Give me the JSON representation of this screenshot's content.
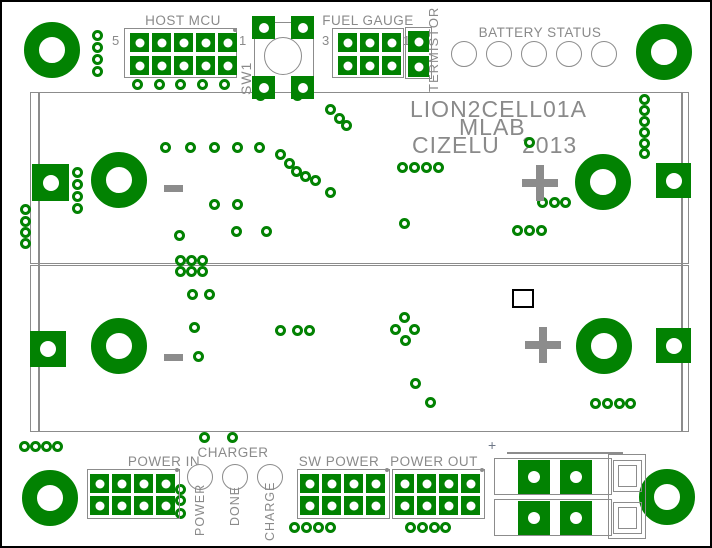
{
  "colors": {
    "pad_green": "#028202",
    "outline_gray": "#8c8c8c",
    "text_gray": "#8a8a8a",
    "frame_black": "#000000"
  },
  "title": {
    "line1": "LION2CELL01A",
    "line2": "MLAB",
    "line3_left": "CIZELU",
    "line3_right": "2013"
  },
  "pcb": {
    "mount_holes": [
      [
        50,
        48
      ],
      [
        662,
        50
      ],
      [
        48,
        496
      ],
      [
        665,
        495
      ]
    ],
    "battery_pads_round": [
      [
        117,
        178
      ],
      [
        601,
        180
      ],
      [
        117,
        344
      ],
      [
        602,
        344
      ]
    ],
    "battery_pads_square": [
      [
        30,
        162,
        37
      ],
      [
        654,
        161,
        35
      ],
      [
        28,
        329,
        36
      ],
      [
        654,
        326,
        35
      ]
    ],
    "holder": {
      "slot1": [
        28,
        90,
        659,
        172
      ],
      "slot2": [
        28,
        263,
        659,
        167
      ],
      "inner_lines_x": [
        36,
        679
      ],
      "inner_top": 90,
      "inner_height": 340
    },
    "headers": [
      {
        "id": "host-mcu",
        "label": "HOST MCU",
        "box": [
          122,
          26,
          113,
          50
        ],
        "cols": 5,
        "rows": 2,
        "x0": 128,
        "y0": 31,
        "pitch_x": 22,
        "pitch_y": 23,
        "pad": 19,
        "label_cx": 181,
        "label_y": 11,
        "pin_left": "5",
        "pl": [
          110,
          31
        ],
        "pin_right": "1",
        "pr": [
          237,
          31
        ],
        "dot": [
          231,
          26
        ]
      },
      {
        "id": "fuel-gauge",
        "label": "FUEL GAUGE",
        "box": [
          330,
          26,
          72,
          50
        ],
        "cols": 3,
        "rows": 2,
        "x0": 336,
        "y0": 31,
        "pitch_x": 22,
        "pitch_y": 23,
        "pad": 19,
        "label_cx": 366,
        "label_y": 11,
        "pin_left": "3",
        "pl": [
          320,
          31
        ],
        "pin_right": "1",
        "pr": [
          401,
          31
        ]
      },
      {
        "id": "termistor",
        "label": "",
        "box": [
          403,
          25,
          27,
          52
        ],
        "cols": 1,
        "rows": 2,
        "x0": 406,
        "y0": 29,
        "pitch_x": 22,
        "pitch_y": 25,
        "pad": 21
      },
      {
        "id": "power-in",
        "label": "POWER IN",
        "box": [
          85,
          467,
          93,
          50
        ],
        "cols": 4,
        "rows": 2,
        "x0": 88,
        "y0": 472,
        "pitch_x": 22,
        "pitch_y": 22,
        "pad": 19,
        "label_cx": 162,
        "label_y": 452,
        "dot": [
          173,
          466
        ]
      },
      {
        "id": "sw-power",
        "label": "SW POWER",
        "box": [
          295,
          467,
          93,
          50
        ],
        "cols": 4,
        "rows": 2,
        "x0": 298,
        "y0": 472,
        "pitch_x": 22,
        "pitch_y": 22,
        "pad": 19,
        "label_cx": 337,
        "label_y": 452,
        "dot": [
          383,
          466
        ]
      },
      {
        "id": "power-out",
        "label": "POWER OUT",
        "box": [
          390,
          467,
          93,
          50
        ],
        "cols": 4,
        "rows": 2,
        "x0": 393,
        "y0": 472,
        "pitch_x": 22,
        "pitch_y": 22,
        "pad": 19,
        "label_cx": 432,
        "label_y": 452,
        "dot": [
          478,
          466
        ]
      }
    ],
    "switch": {
      "id": "sw1",
      "outline": [
        252,
        20,
        60,
        71
      ],
      "pads": [
        [
          250,
          14
        ],
        [
          289,
          14
        ],
        [
          250,
          74
        ],
        [
          289,
          74
        ]
      ],
      "pad_size": 23,
      "circle": [
        262,
        35,
        38,
        38
      ]
    },
    "led_groups": [
      {
        "id": "battery-status",
        "label": "BATTERY STATUS",
        "label_cx": 538,
        "label_y": 23,
        "cx0": 462,
        "cy": 52,
        "step": 35,
        "r": 13,
        "count": 5
      },
      {
        "id": "charger",
        "label": "CHARGER",
        "label_cx": 231,
        "label_y": 443,
        "cx0": 198,
        "cy": 475,
        "step": 35,
        "r": 13,
        "count": 3
      }
    ],
    "vertical_labels": [
      {
        "id": "sw1-label",
        "text": "SW1",
        "x": 236,
        "y": 93,
        "fs": 14
      },
      {
        "id": "termistor-label",
        "text": "TERMISTOR",
        "x": 424,
        "y": 90,
        "fs": 13
      },
      {
        "id": "charger-led-power-label",
        "text": "POWER",
        "x": 191,
        "y": 534,
        "fs": 12.5
      },
      {
        "id": "charger-led-done-label",
        "text": "DONE",
        "x": 226,
        "y": 524,
        "fs": 12.5
      },
      {
        "id": "charger-led-charge-label",
        "text": "CHARGE",
        "x": 261,
        "y": 539,
        "fs": 12.5
      }
    ],
    "polarity_marks": [
      {
        "type": "minus",
        "x": 162,
        "y": 183
      },
      {
        "type": "plus",
        "cx": 538,
        "cy": 181
      },
      {
        "type": "minus",
        "x": 162,
        "y": 352
      },
      {
        "type": "plus",
        "cx": 541,
        "cy": 343
      }
    ],
    "white_square": [
      510,
      287,
      22,
      19
    ],
    "terminal": {
      "plus_label": "+",
      "top_line": [
        505,
        450,
        116,
        2
      ],
      "bracket": [
        606,
        452,
        38,
        85
      ],
      "rows": [
        [
          492,
          456,
          118,
          37
        ],
        [
          492,
          497,
          118,
          37
        ]
      ],
      "pads": [
        [
          516,
          458
        ],
        [
          558,
          458
        ],
        [
          516,
          499
        ],
        [
          558,
          499
        ]
      ],
      "pad_size": [
        32,
        34
      ],
      "squares": [
        [
          611,
          458,
          29,
          32
        ],
        [
          611,
          500,
          29,
          32
        ]
      ],
      "square_inner_offset": 5
    },
    "vias": [
      [
        95,
        33
      ],
      [
        95,
        45
      ],
      [
        95,
        57
      ],
      [
        95,
        69
      ],
      [
        135,
        82
      ],
      [
        157,
        82
      ],
      [
        178,
        82
      ],
      [
        200,
        82
      ],
      [
        222,
        82
      ],
      [
        258,
        93
      ],
      [
        295,
        93
      ],
      [
        328,
        107
      ],
      [
        337,
        116
      ],
      [
        344,
        123
      ],
      [
        163,
        145
      ],
      [
        188,
        145
      ],
      [
        212,
        145
      ],
      [
        235,
        145
      ],
      [
        257,
        145
      ],
      [
        278,
        152
      ],
      [
        287,
        161
      ],
      [
        294,
        169
      ],
      [
        303,
        174
      ],
      [
        313,
        178
      ],
      [
        328,
        190
      ],
      [
        212,
        202
      ],
      [
        235,
        202
      ],
      [
        75,
        170
      ],
      [
        75,
        182
      ],
      [
        75,
        194
      ],
      [
        75,
        206
      ],
      [
        23,
        207
      ],
      [
        23,
        219
      ],
      [
        23,
        230
      ],
      [
        23,
        241
      ],
      [
        400,
        165
      ],
      [
        412,
        165
      ],
      [
        424,
        165
      ],
      [
        436,
        165
      ],
      [
        527,
        140
      ],
      [
        402,
        221
      ],
      [
        642,
        97
      ],
      [
        642,
        108
      ],
      [
        642,
        119
      ],
      [
        642,
        130
      ],
      [
        642,
        141
      ],
      [
        642,
        151
      ],
      [
        540,
        200
      ],
      [
        552,
        200
      ],
      [
        563,
        200
      ],
      [
        515,
        228
      ],
      [
        527,
        228
      ],
      [
        539,
        228
      ],
      [
        177,
        233
      ],
      [
        234,
        229
      ],
      [
        264,
        229
      ],
      [
        178,
        258
      ],
      [
        189,
        258
      ],
      [
        200,
        258
      ],
      [
        178,
        269
      ],
      [
        189,
        269
      ],
      [
        200,
        269
      ],
      [
        190,
        292
      ],
      [
        207,
        292
      ],
      [
        192,
        325
      ],
      [
        196,
        354
      ],
      [
        278,
        328
      ],
      [
        295,
        328
      ],
      [
        307,
        328
      ],
      [
        402,
        315
      ],
      [
        393,
        327
      ],
      [
        412,
        327
      ],
      [
        403,
        338
      ],
      [
        413,
        381
      ],
      [
        428,
        400
      ],
      [
        593,
        401
      ],
      [
        605,
        401
      ],
      [
        617,
        401
      ],
      [
        628,
        401
      ],
      [
        22,
        444
      ],
      [
        33,
        444
      ],
      [
        44,
        444
      ],
      [
        55,
        444
      ],
      [
        202,
        435
      ],
      [
        230,
        435
      ],
      [
        178,
        487
      ],
      [
        178,
        498
      ],
      [
        178,
        511
      ],
      [
        292,
        525
      ],
      [
        304,
        525
      ],
      [
        316,
        525
      ],
      [
        328,
        525
      ],
      [
        408,
        525
      ],
      [
        420,
        525
      ],
      [
        432,
        525
      ],
      [
        443,
        525
      ]
    ]
  }
}
